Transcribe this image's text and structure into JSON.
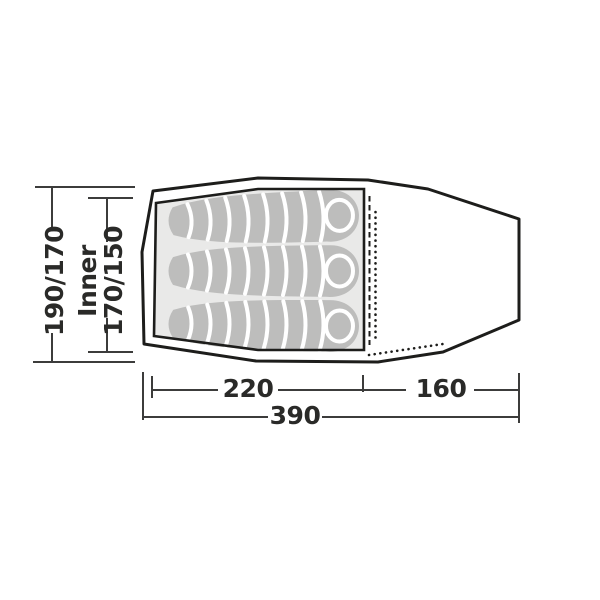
{
  "diagram": {
    "type": "tent-floorplan-top-view",
    "occupants": 3,
    "dimensions": {
      "outer_width_label": "190/170",
      "inner_width_label_line1": "Inner",
      "inner_width_label_line2": "170/150",
      "inner_length_label": "220",
      "vestibule_length_label": "160",
      "total_length_label": "390"
    },
    "colors": {
      "outline": "#1d1d1b",
      "dimension_lines": "#3c3c3b",
      "inner_floor": "#e9e9e8",
      "sleeping_bag": "#bdbdbc",
      "separator": "#ffffff",
      "text": "#2a2a28",
      "background": "#ffffff"
    }
  }
}
